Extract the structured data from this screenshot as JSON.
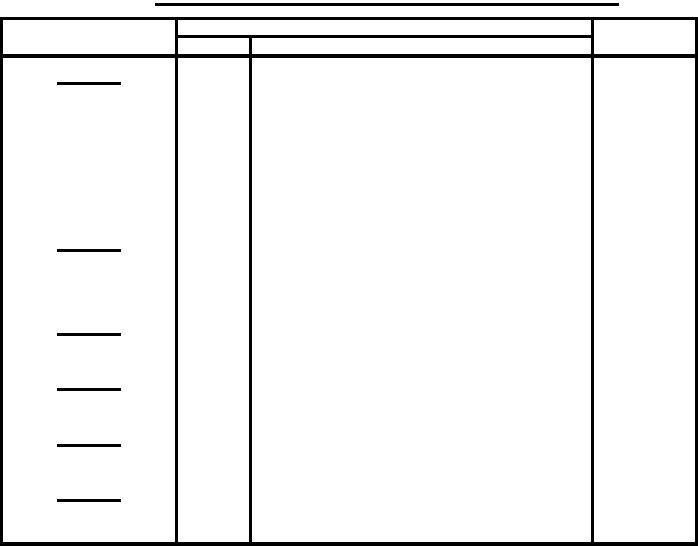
{
  "document": {
    "background_color": "#ffffff",
    "line_color": "#000000"
  },
  "title": {
    "text": "",
    "underlined": true
  },
  "table": {
    "header": {
      "left_cell_text": "",
      "merged_cell_text": "",
      "small_sub_cell_text": "",
      "large_sub_cell_text": "",
      "right_cell_text": ""
    },
    "blank_lines": {
      "x": 57,
      "width": 64,
      "thickness": 3,
      "y_positions": [
        82,
        249,
        333,
        388,
        444,
        499
      ]
    }
  }
}
